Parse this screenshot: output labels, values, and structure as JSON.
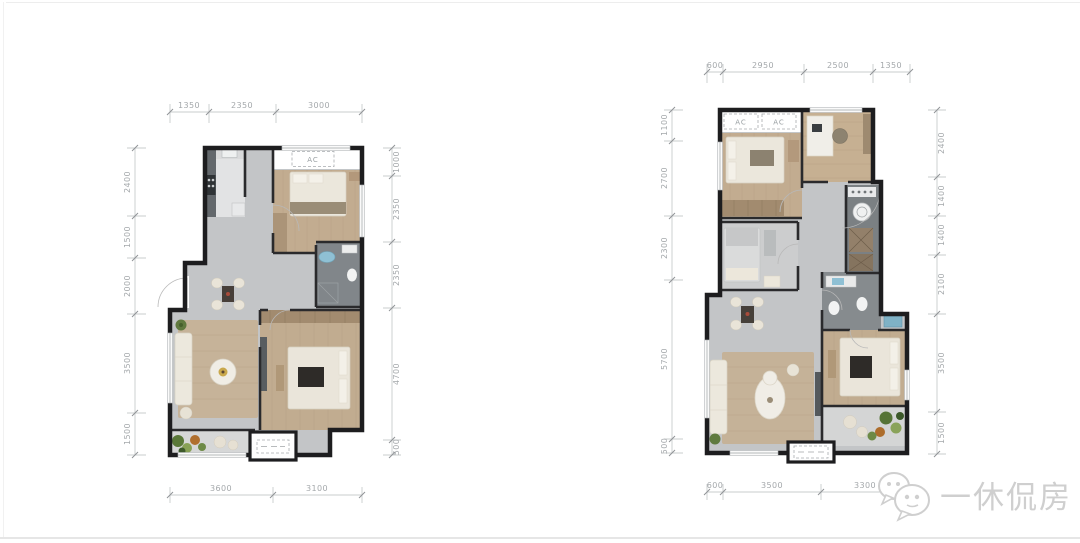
{
  "watermark": {
    "text": "一休侃房",
    "color": "#cfcfcf",
    "logo": "wechat-bubbles-icon"
  },
  "colors": {
    "wall": "#1d1d1f",
    "tile_floor": "#c3c5c7",
    "wood_floor": "#c2ac90",
    "dark_gray_room": "#81868a",
    "dimension_text": "#a4a8ab",
    "plant_green": "#5a7838",
    "accent_blue": "#8fc0d4",
    "watermark_gray": "#cfcfcf"
  },
  "plans": {
    "left": {
      "dims_top": [
        "1350",
        "2350",
        "3000"
      ],
      "dims_left": [
        "2400",
        "1500",
        "2000",
        "3500",
        "1500"
      ],
      "dims_right": [
        "1000",
        "2350",
        "2350",
        "4700",
        "500"
      ],
      "dims_bottom": [
        "3600",
        "3100"
      ],
      "ac_labels": [
        "AC"
      ]
    },
    "right": {
      "dims_top": [
        "600",
        "2950",
        "2500",
        "1350"
      ],
      "dims_left": [
        "1100",
        "2700",
        "2300",
        "5700",
        "500"
      ],
      "dims_right": [
        "2400",
        "1400",
        "1400",
        "2100",
        "3500",
        "1500"
      ],
      "dims_bottom": [
        "600",
        "3500",
        "3300"
      ],
      "ac_labels": [
        "AC",
        "AC"
      ]
    }
  }
}
